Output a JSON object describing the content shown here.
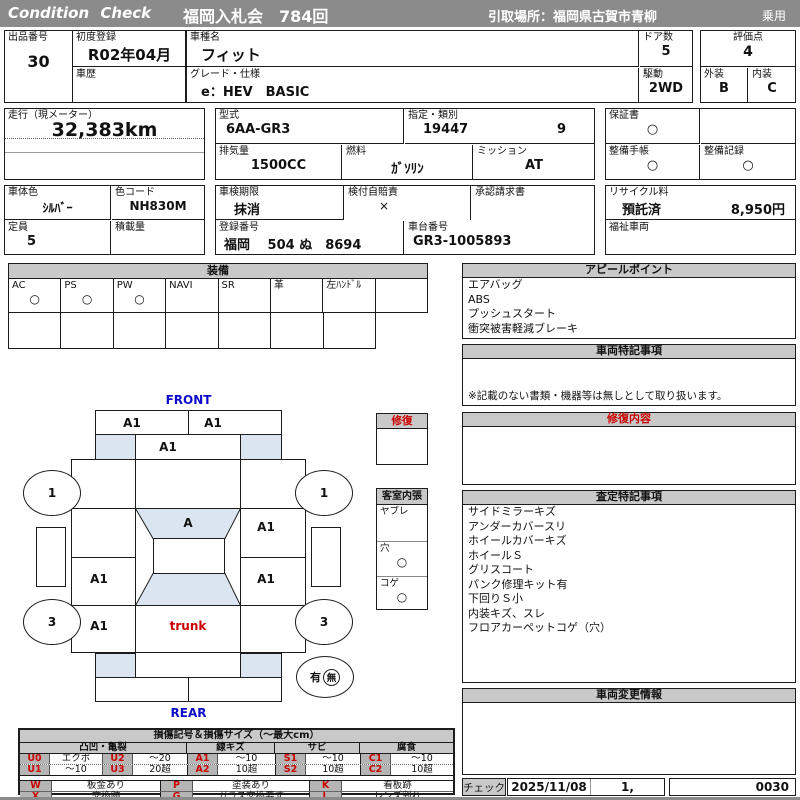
{
  "header": {
    "brand": "Condition  Check",
    "auction": "福岡入札会　784回",
    "pickup": "引取場所：福岡県古賀市青柳",
    "category": "乗用"
  },
  "info": {
    "lot_label": "出品番号",
    "lot_value": "30",
    "first_reg_label": "初度登録",
    "first_reg_value": "R02年04月",
    "history_label": "車歴",
    "model_name_label": "車種名",
    "model_name_value": "フィット",
    "grade_label": "グレード・仕様",
    "grade_value": "e：HEV　BASIC",
    "doors_label": "ドア数",
    "doors_value": "5",
    "drive_label": "駆動",
    "drive_value": "2WD",
    "score_label": "評価点",
    "score_value": "4",
    "exterior_label": "外装",
    "exterior_value": "B",
    "interior_label": "内装",
    "interior_value": "C",
    "mileage_label": "走行（現メーター）",
    "mileage_value": "32,383km",
    "model_code_label": "型式",
    "model_code_value": "6AA-GR3",
    "class_label": "指定・類別",
    "class_value1": "19447",
    "class_value2": "9",
    "warranty_label": "保証書",
    "warranty_value": "○",
    "displacement_label": "排気量",
    "displacement_value": "1500CC",
    "fuel_label": "燃料",
    "fuel_value": "ｶﾞｿﾘﾝ",
    "mission_label": "ミッション",
    "mission_value": "AT",
    "maintenance_book_label": "整備手帳",
    "maintenance_book_value": "○",
    "maintenance_record_label": "整備記録",
    "maintenance_record_value": "○",
    "color_label": "車体色",
    "color_value": "ｼﾙﾊﾞｰ",
    "color_code_label": "色コード",
    "color_code_value": "NH830M",
    "inspection_label": "車検期限",
    "inspection_value": "抹消",
    "insurance_label": "検付自賠責",
    "insurance_value": "×",
    "approval_label": "承認請求書",
    "recycle_label": "リサイクル料",
    "recycle_status": "預託済",
    "recycle_fee": "8,950円",
    "capacity_label": "定員",
    "capacity_value": "5",
    "load_label": "積載量",
    "reg_no_label": "登録番号",
    "reg_no_value": "福岡　 504 ぬ　8694",
    "chassis_label": "車台番号",
    "chassis_value": "GR3-1005893",
    "welfare_label": "福祉車両"
  },
  "equipment": {
    "title": "装備",
    "columns": [
      {
        "label": "AC",
        "value": "○"
      },
      {
        "label": "PS",
        "value": "○"
      },
      {
        "label": "PW",
        "value": "○"
      },
      {
        "label": "NAVI",
        "value": ""
      },
      {
        "label": "SR",
        "value": ""
      },
      {
        "label": "革",
        "value": ""
      },
      {
        "label": "左ﾊﾝﾄﾞﾙ",
        "value": ""
      }
    ]
  },
  "panels": {
    "appeal": {
      "title": "アピールポイント",
      "items": [
        "エアバッグ",
        "ABS",
        "プッシュスタート",
        "衝突被害軽減ブレーキ"
      ]
    },
    "vehicle_notes": {
      "title": "車両特記事項",
      "note": "※記載のない書類・機器等は無しとして取り扱います。"
    },
    "repair": {
      "title": "修復内容"
    },
    "assessment": {
      "title": "査定特記事項",
      "items": [
        "サイドミラーキズ",
        "アンダーカバースリ",
        "ホイールカバーキズ",
        "ホイールＳ",
        "グリスコート",
        "パンク修理キット有",
        "下回りＳ小",
        "内装キズ、スレ",
        "フロアカーペットコゲ（穴）"
      ]
    },
    "changes": {
      "title": "車両変更情報"
    }
  },
  "diagram": {
    "front_label": "FRONT",
    "rear_label": "REAR",
    "trunk_label": "trunk",
    "marks": {
      "bumper_front_left": "A1",
      "bumper_front_right": "A1",
      "hood": "A1",
      "windshield": "A",
      "right_front_door": "A1",
      "left_rear_door": "A1",
      "right_rear_door": "A1",
      "left_quarter": "A1"
    },
    "wheels": {
      "front_left": "1",
      "front_right": "1",
      "rear_left": "3",
      "rear_right": "3"
    },
    "spare": {
      "present_label": "有",
      "absent_label": "無"
    },
    "repair_box_title": "修復",
    "interior_box_title": "客室内張",
    "interior_rows": [
      {
        "label": "ヤブレ",
        "value": ""
      },
      {
        "label": "穴",
        "value": "○"
      },
      {
        "label": "コゲ",
        "value": "○"
      }
    ]
  },
  "legend": {
    "title": "損傷記号＆損傷サイズ（～最大cm）",
    "groups": [
      "凸凹・亀裂",
      "線キズ",
      "サビ",
      "腐食"
    ],
    "rows": [
      [
        {
          "code": "U0",
          "size": "エクボ"
        },
        {
          "code": "U2",
          "size": "～20"
        },
        {
          "code": "A1",
          "size": "～10"
        },
        {
          "code": "S1",
          "size": "～10"
        },
        {
          "code": "C1",
          "size": "～10"
        }
      ],
      [
        {
          "code": "U1",
          "size": "～10"
        },
        {
          "code": "U3",
          "size": "20超"
        },
        {
          "code": "A2",
          "size": "10超"
        },
        {
          "code": "S2",
          "size": "10超"
        },
        {
          "code": "C2",
          "size": "10超"
        }
      ]
    ],
    "extra_rows": [
      [
        {
          "code": "W",
          "desc": "板金あり"
        },
        {
          "code": "P",
          "desc": "塗装あり"
        },
        {
          "code": "K",
          "desc": "看板跡"
        }
      ],
      [
        {
          "code": "X",
          "desc": "交換跡"
        },
        {
          "code": "G",
          "desc": "ガラス交換要す"
        },
        {
          "code": "L",
          "desc": "レンズ割れ"
        }
      ]
    ]
  },
  "footer": {
    "check_label": "チェック",
    "date": "2025/11/08",
    "count": "1,",
    "code": "0030"
  }
}
